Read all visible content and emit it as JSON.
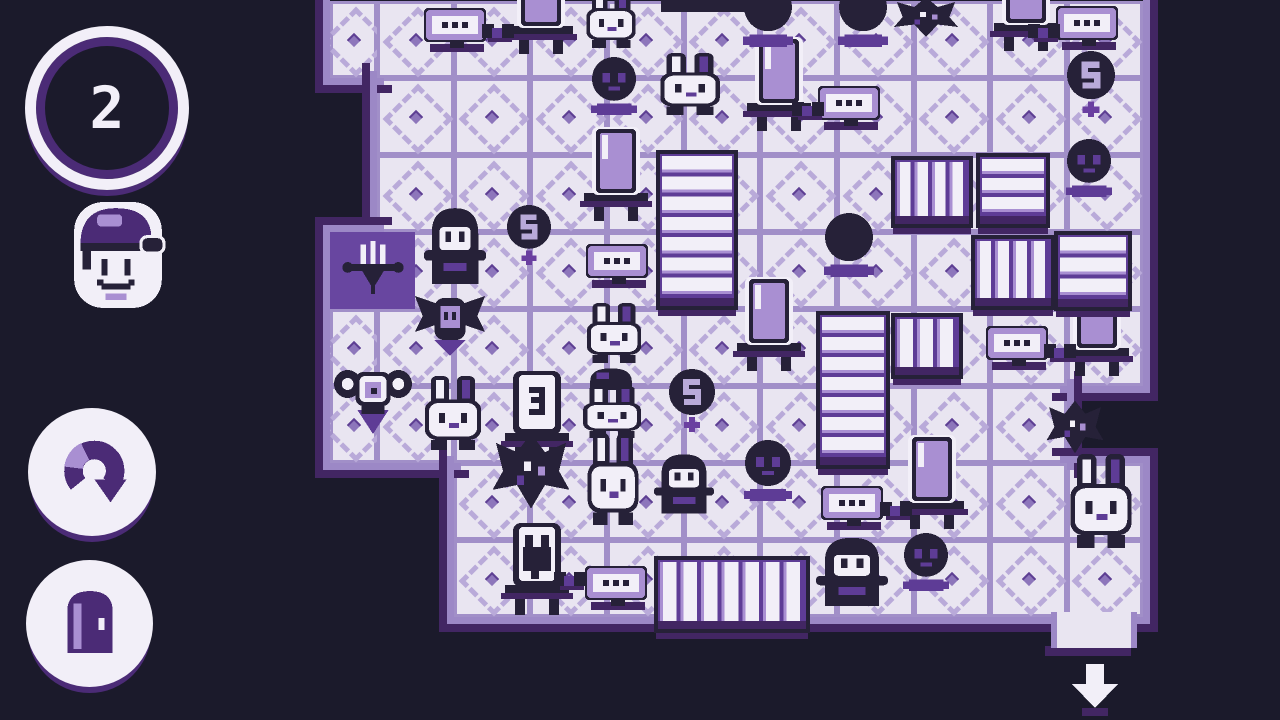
{
  "palette": {
    "navy": "#1b1a2b",
    "outline": "#262138",
    "floor": "#e9e5f1",
    "grid": "#a18fc8",
    "dash": "#b9aad9",
    "mid": "#5e3c96",
    "wall": "#6846a0",
    "darkband": "#422663",
    "lavender": "#a98fd2",
    "white": "#f2eff8",
    "ring": "#4b2b76",
    "dotcore": "#5e3f93"
  },
  "sidebar": {
    "counter": {
      "value": "2"
    },
    "avatar": {
      "icon": "player-avatar-icon"
    },
    "undo": {
      "icon": "undo-icon"
    },
    "exit": {
      "icon": "door-icon"
    }
  },
  "board": {
    "col_bounds": [
      330,
      377,
      454,
      530,
      607,
      684,
      760,
      837,
      914,
      990,
      1067,
      1143
    ],
    "row_bounds": [
      1,
      78,
      155,
      232,
      309,
      386,
      463,
      540,
      617
    ],
    "legend": {
      "F": "floor",
      "W": "chandelier-wall",
      ".": "outside"
    },
    "map": [
      "FFFFFFFFFFF",
      ".FFFFFFFFFF",
      ".FFFFFFFFFF",
      "WFFFFFFFFFF",
      "FFFFFFFFFFF",
      "FFFFFFFFFF.",
      "..FFFFFFFFF",
      "..FFFFFFFFF"
    ]
  },
  "objects": [
    {
      "t": "walltile",
      "x": 330,
      "y": 232,
      "w": 85,
      "h": 77
    },
    {
      "t": "bar",
      "x": 661,
      "y": 0,
      "w": 102,
      "h": 12
    },
    {
      "t": "lamp",
      "x": 503,
      "y": -40
    },
    {
      "t": "lamp",
      "x": 741,
      "y": 37
    },
    {
      "t": "lamp",
      "x": 988,
      "y": -43
    },
    {
      "t": "lamp",
      "x": 578,
      "y": 127
    },
    {
      "t": "lamp",
      "x": 731,
      "y": 277
    },
    {
      "t": "lamp",
      "x": 1059,
      "y": 282
    },
    {
      "t": "lamp",
      "x": 894,
      "y": 435
    },
    {
      "t": "jar",
      "v": "e",
      "x": 499,
      "y": 371
    },
    {
      "t": "jar",
      "v": "bunny",
      "x": 499,
      "y": 523
    },
    {
      "t": "machine",
      "x": 424,
      "y": 6
    },
    {
      "t": "cable",
      "x": 482,
      "y": 20
    },
    {
      "t": "machine",
      "x": 818,
      "y": 84
    },
    {
      "t": "cable",
      "x": 792,
      "y": 98
    },
    {
      "t": "machine",
      "x": 1056,
      "y": 4
    },
    {
      "t": "cable",
      "x": 1028,
      "y": 20
    },
    {
      "t": "machine",
      "x": 586,
      "y": 242
    },
    {
      "t": "machine",
      "x": 986,
      "y": 324
    },
    {
      "t": "cable",
      "x": 1044,
      "y": 340
    },
    {
      "t": "machine",
      "x": 821,
      "y": 484
    },
    {
      "t": "cable",
      "x": 880,
      "y": 498
    },
    {
      "t": "machine",
      "x": 585,
      "y": 564
    },
    {
      "t": "cable",
      "x": 554,
      "y": 568
    },
    {
      "t": "crate",
      "x": 656,
      "y": 150,
      "w": 82,
      "h": 160,
      "o": "h",
      "s": 7
    },
    {
      "t": "crate",
      "x": 816,
      "y": 311,
      "w": 74,
      "h": 158,
      "o": "h",
      "s": 7
    },
    {
      "t": "crate",
      "x": 891,
      "y": 156,
      "w": 82,
      "h": 72,
      "o": "v",
      "s": 4
    },
    {
      "t": "crate",
      "x": 971,
      "y": 235,
      "w": 84,
      "h": 75,
      "o": "v",
      "s": 4
    },
    {
      "t": "crate",
      "x": 891,
      "y": 313,
      "w": 72,
      "h": 66,
      "o": "v",
      "s": 3
    },
    {
      "t": "crate",
      "x": 976,
      "y": 153,
      "w": 74,
      "h": 75,
      "o": "h",
      "s": 3
    },
    {
      "t": "crate",
      "x": 1054,
      "y": 231,
      "w": 78,
      "h": 80,
      "o": "h",
      "s": 3
    },
    {
      "t": "crate",
      "x": 654,
      "y": 556,
      "w": 156,
      "h": 77,
      "o": "v",
      "s": 7
    },
    {
      "t": "ball",
      "x": 591,
      "y": 56,
      "d": 46,
      "v": "face",
      "c": true
    },
    {
      "t": "ball",
      "x": 743,
      "y": -18,
      "d": 50,
      "v": "plain",
      "c": true
    },
    {
      "t": "ball",
      "x": 838,
      "y": -18,
      "d": 50,
      "v": "plain",
      "c": true
    },
    {
      "t": "ball",
      "x": 1066,
      "y": 50,
      "d": 50,
      "v": "s",
      "p": true
    },
    {
      "t": "ball",
      "x": 1066,
      "y": 138,
      "d": 46,
      "v": "face",
      "c": true
    },
    {
      "t": "ball",
      "x": 506,
      "y": 204,
      "d": 46,
      "v": "s",
      "p": true
    },
    {
      "t": "ball",
      "x": 824,
      "y": 212,
      "d": 50,
      "v": "plain",
      "c": true
    },
    {
      "t": "ball",
      "x": 668,
      "y": 368,
      "d": 48,
      "v": "s",
      "p": true
    },
    {
      "t": "ball",
      "x": 744,
      "y": 439,
      "d": 48,
      "v": "face",
      "c": true
    },
    {
      "t": "ball",
      "x": 903,
      "y": 532,
      "d": 46,
      "v": "face",
      "c": true
    },
    {
      "t": "moth",
      "x": 891,
      "y": -8,
      "w": 70,
      "h": 50
    },
    {
      "t": "moth",
      "x": 489,
      "y": 424,
      "w": 84,
      "h": 94
    },
    {
      "t": "moth",
      "x": 1044,
      "y": 394,
      "w": 62,
      "h": 66
    },
    {
      "t": "bunny",
      "x": 583,
      "y": -10,
      "w": 56,
      "h": 58
    },
    {
      "t": "bunny",
      "x": 656,
      "y": 53,
      "w": 68,
      "h": 62
    },
    {
      "t": "bunny",
      "x": 583,
      "y": 303,
      "w": 62,
      "h": 60
    },
    {
      "t": "dome",
      "x": 586,
      "y": 364,
      "w": 50,
      "h": 26
    },
    {
      "t": "bunny",
      "x": 579,
      "y": 386,
      "w": 66,
      "h": 52
    },
    {
      "t": "bunny",
      "x": 584,
      "y": 433,
      "w": 58,
      "h": 92
    },
    {
      "t": "bunny",
      "x": 1066,
      "y": 454,
      "w": 70,
      "h": 94
    },
    {
      "t": "ghost",
      "x": 424,
      "y": 204,
      "w": 62,
      "h": 84
    },
    {
      "t": "ghost",
      "x": 654,
      "y": 451,
      "w": 60,
      "h": 66
    },
    {
      "t": "ghost",
      "x": 816,
      "y": 534,
      "w": 72,
      "h": 76
    },
    {
      "t": "bat",
      "x": 411,
      "y": 292,
      "w": 78,
      "h": 64
    },
    {
      "t": "horned",
      "x": 334,
      "y": 366,
      "w": 78,
      "h": 72
    },
    {
      "t": "bunny",
      "x": 421,
      "y": 376,
      "w": 64,
      "h": 74
    }
  ],
  "exit": {
    "door": {
      "x": 1051,
      "y": 612,
      "w": 74,
      "h": 36
    },
    "shadow": {
      "x": 1045,
      "y": 646,
      "w": 86,
      "h": 10
    },
    "arrow": {
      "x": 1070,
      "y": 664,
      "w": 50,
      "h": 52
    }
  }
}
